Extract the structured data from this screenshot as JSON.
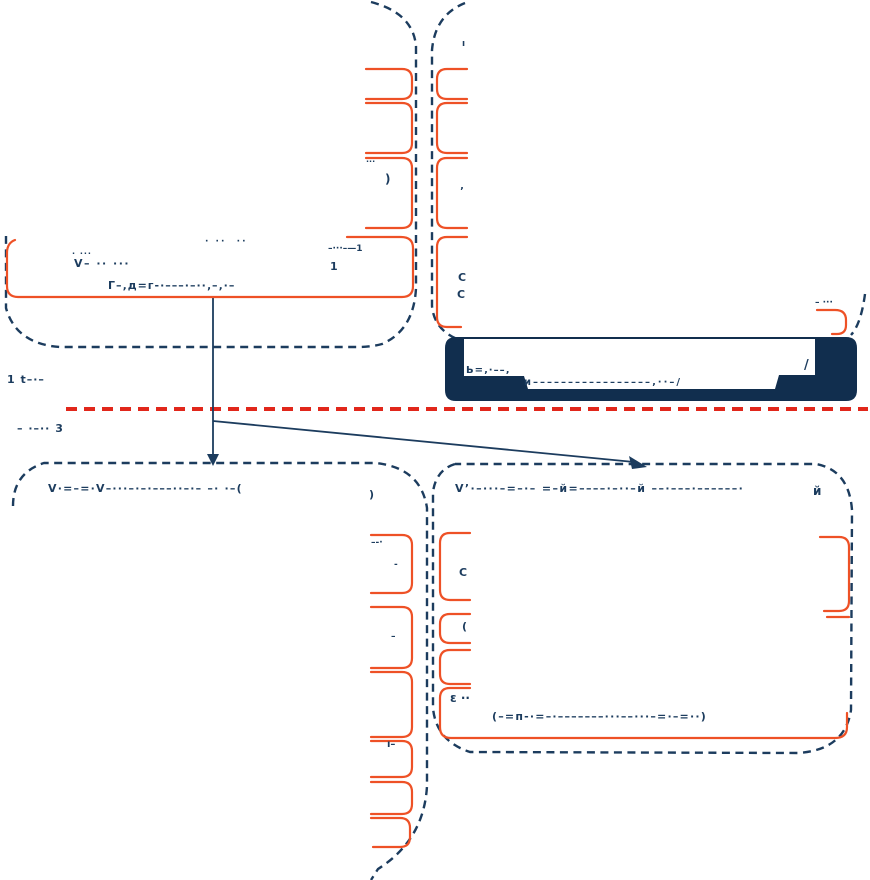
{
  "colors": {
    "navy": "#1c3c5e",
    "navy_dark": "#112e4e",
    "orange": "#ee5126",
    "red": "#e1271b"
  },
  "fragments": {
    "f1": "· ··  ··",
    "f2a": "· ···",
    "f2b": "V– ·· ···",
    "f3": "Г–‚д=г-·–––·–··‚–‚·–",
    "f4a": "–···–—1",
    "f4b": "1",
    "f5a": ")",
    "f5b": "‚",
    "f6": "···",
    "f7a": "C",
    "f7b": "C",
    "f8": "ı",
    "f9": "1 t–·–",
    "f10": "– ·–·· 3",
    "f11": "Ь=‚·––‚",
    "f12": "и–––––––––––––––––‚··–/",
    "f13": "/",
    "f14a": "V·=–=·V–···–·–·–––··–·– –· ·–(",
    "f14b": ")",
    "f15a": "V’·–···–=–·– =–й=––––·–··–й ––·–––·––––––·",
    "f15b": "й",
    "f16": "(–=п-·=–·–––––––···––···–=·–=··)",
    "f17": "ε ··",
    "f18": "(",
    "f19": "C",
    "f20a": "–-·",
    "f20b": "-",
    "f21": "ı–",
    "f22": "–",
    "f23": "– ···"
  }
}
